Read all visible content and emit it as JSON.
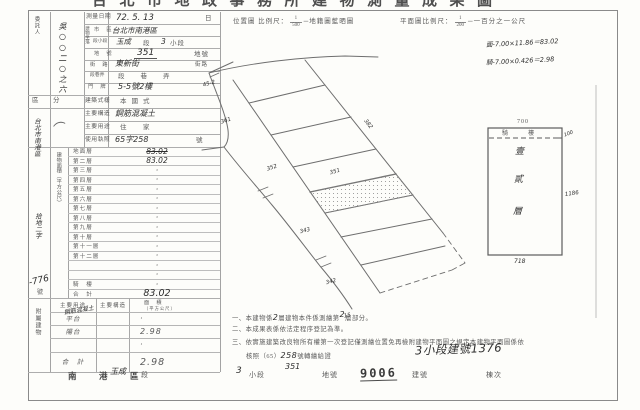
{
  "page": {
    "title_clipped": "台北市地政事務所建物測量成果圖"
  },
  "header": {
    "loc_scale_label": "位置圖 比例尺：",
    "loc_scale_num": "1",
    "loc_scale_den": "500",
    "loc_scale_suffix": "─地籍圖藍晒圖",
    "plan_scale_label": "平面圖比例尺：",
    "plan_scale_num": "1",
    "plan_scale_den": "200",
    "plan_scale_suffix": "─一百分之一公尺",
    "calc_line1": "面-7.00×11.86＝83.02",
    "calc_line2": "騎-7.00×0.426＝2.98"
  },
  "left_form": {
    "client_label": "委託人",
    "client_hw_vertical": "吳○○二○之六",
    "address_hw_vertical": "台北市南港區",
    "bracket_mark": "（",
    "receipt_hw": "拾地二字",
    "receipt_no_hw": "-776",
    "receipt_no_suffix": "號",
    "category_label": "區　分",
    "rows_top": {
      "date_label": "測量日期",
      "date_value": "72. 5. 13",
      "date_suffix": "日",
      "situs_label": "建物坐落",
      "city_label": "市　區",
      "city_value": "台北市南港區",
      "sect_label": "段小段",
      "sect_hw1": "玉成",
      "sect_p1": "段",
      "sect_hw2": "3",
      "sect_p2": "小段",
      "lot_label": "地　號",
      "lot_hw": "351",
      "lot_suffix": "地號",
      "street_label": "街　路",
      "street_hw": "東新街",
      "street_suffix": "街路",
      "lane_label": "段巷弄",
      "lane_value": "段　　巷　　弄",
      "no_label": "門　牌",
      "no_hw": "5-5號2樓"
    },
    "rows_mid": [
      {
        "label": "建築式樣",
        "value": "本國式",
        "hw": false,
        "suffix": ""
      },
      {
        "label": "主要構造",
        "value": "鋼筋混凝土",
        "hw": true,
        "suffix": ""
      },
      {
        "label": "主要用途",
        "value": "住　家",
        "hw": false,
        "suffix": ""
      },
      {
        "label": "使用執照",
        "value": "65字258",
        "hw": true,
        "suffix": "號"
      }
    ],
    "area_label_vertical": "建物面積（平方公尺）",
    "floors": [
      {
        "label": "地面層",
        "value": "83.02",
        "struck": true,
        "total": false
      },
      {
        "label": "第二層",
        "value": "83.02",
        "struck": false,
        "total": false
      },
      {
        "label": "第三層",
        "value": "·",
        "struck": false,
        "total": false
      },
      {
        "label": "第四層",
        "value": "·",
        "struck": false,
        "total": false
      },
      {
        "label": "第五層",
        "value": "·",
        "struck": false,
        "total": false
      },
      {
        "label": "第六層",
        "value": "·",
        "struck": false,
        "total": false
      },
      {
        "label": "第七層",
        "value": "·",
        "struck": false,
        "total": false
      },
      {
        "label": "第八層",
        "value": "·",
        "struck": false,
        "total": false
      },
      {
        "label": "第九層",
        "value": "·",
        "struck": false,
        "total": false
      },
      {
        "label": "第十層",
        "value": "·",
        "struck": false,
        "total": false
      },
      {
        "label": "第十一層",
        "value": "·",
        "struck": false,
        "total": false
      },
      {
        "label": "第十二層",
        "value": "·",
        "struck": false,
        "total": false
      },
      {
        "label": "",
        "value": "·",
        "struck": false,
        "total": false
      },
      {
        "label": "",
        "value": "·",
        "struck": false,
        "total": false
      },
      {
        "label": "騎　樓",
        "value": "·",
        "struck": false,
        "total": false
      },
      {
        "label": "合　計",
        "value": "83.02",
        "struck": false,
        "total": true
      }
    ],
    "annex": {
      "side_label": "附屬建物",
      "header_use": "主要用途",
      "header_struct": "主要構造",
      "header_area1": "面　積",
      "header_area2": "（平方公尺）",
      "rows": [
        {
          "use": "平台",
          "struct": "",
          "area": "·",
          "total": false
        },
        {
          "use": "陽台",
          "struct": "",
          "area": "2.98",
          "total": false
        },
        {
          "use": "",
          "struct": "",
          "area": "·",
          "total": false
        },
        {
          "use": "合　計",
          "struct": "",
          "area": "2.98",
          "total": true
        }
      ],
      "hw_note": "鋼筋混凝土"
    }
  },
  "plan": {
    "labels": [
      {
        "t": "45-2",
        "x": 203,
        "y": 82,
        "r": -15
      },
      {
        "t": "361",
        "x": 221,
        "y": 119,
        "r": -18
      },
      {
        "t": "352",
        "x": 267,
        "y": 166,
        "r": -18
      },
      {
        "t": "351",
        "x": 330,
        "y": 170,
        "r": -16
      },
      {
        "t": "382",
        "x": 362,
        "y": 122,
        "r": 52
      },
      {
        "t": "343",
        "x": 300,
        "y": 229,
        "r": -14
      },
      {
        "t": "342",
        "x": 326,
        "y": 280,
        "r": -14
      },
      {
        "t": "15",
        "x": 344,
        "y": 314,
        "r": -10
      }
    ],
    "floorplan": {
      "arcade_label": "騎　樓",
      "dim_top": "700",
      "dim_right_small": "100",
      "dim_right": "1186",
      "dim_bottom": "718",
      "inner_chars": [
        "壹",
        "貳",
        "層"
      ]
    }
  },
  "notes": {
    "n1_pre": "一、本建物係",
    "n1_hw1": "2",
    "n1_mid": "層建物本件係測繪第",
    "n1_hw2": "2",
    "n1_post": "層部分。",
    "n2": "二、本成果表係依法定程序登記為準。",
    "n3": "三、依實施建築改良物所有權第一次登記僅測繪位置免再檢附建物平面圖之規定本建物平面圖係依",
    "n4_pre": "核照（65）",
    "n4_hw": "258",
    "n4_post": "號轉繪給證",
    "n4_big_hw": "3小段建號1376"
  },
  "footer": {
    "district": "南　港　區",
    "sect_hw": "玉成",
    "sect_label": "段",
    "sub_hw": "3",
    "sub_label": "小段",
    "lot_hw": "351",
    "lot_label": "地號",
    "bldg_stamp": "9006",
    "bldg_label": "建號",
    "unit_label": "棟次"
  },
  "colors": {
    "ink": "#3c3c3c",
    "print": "#5a5a5a",
    "line": "#a3a3a3",
    "hw": "#2d2d2d",
    "paper": "#fdfdfa"
  }
}
